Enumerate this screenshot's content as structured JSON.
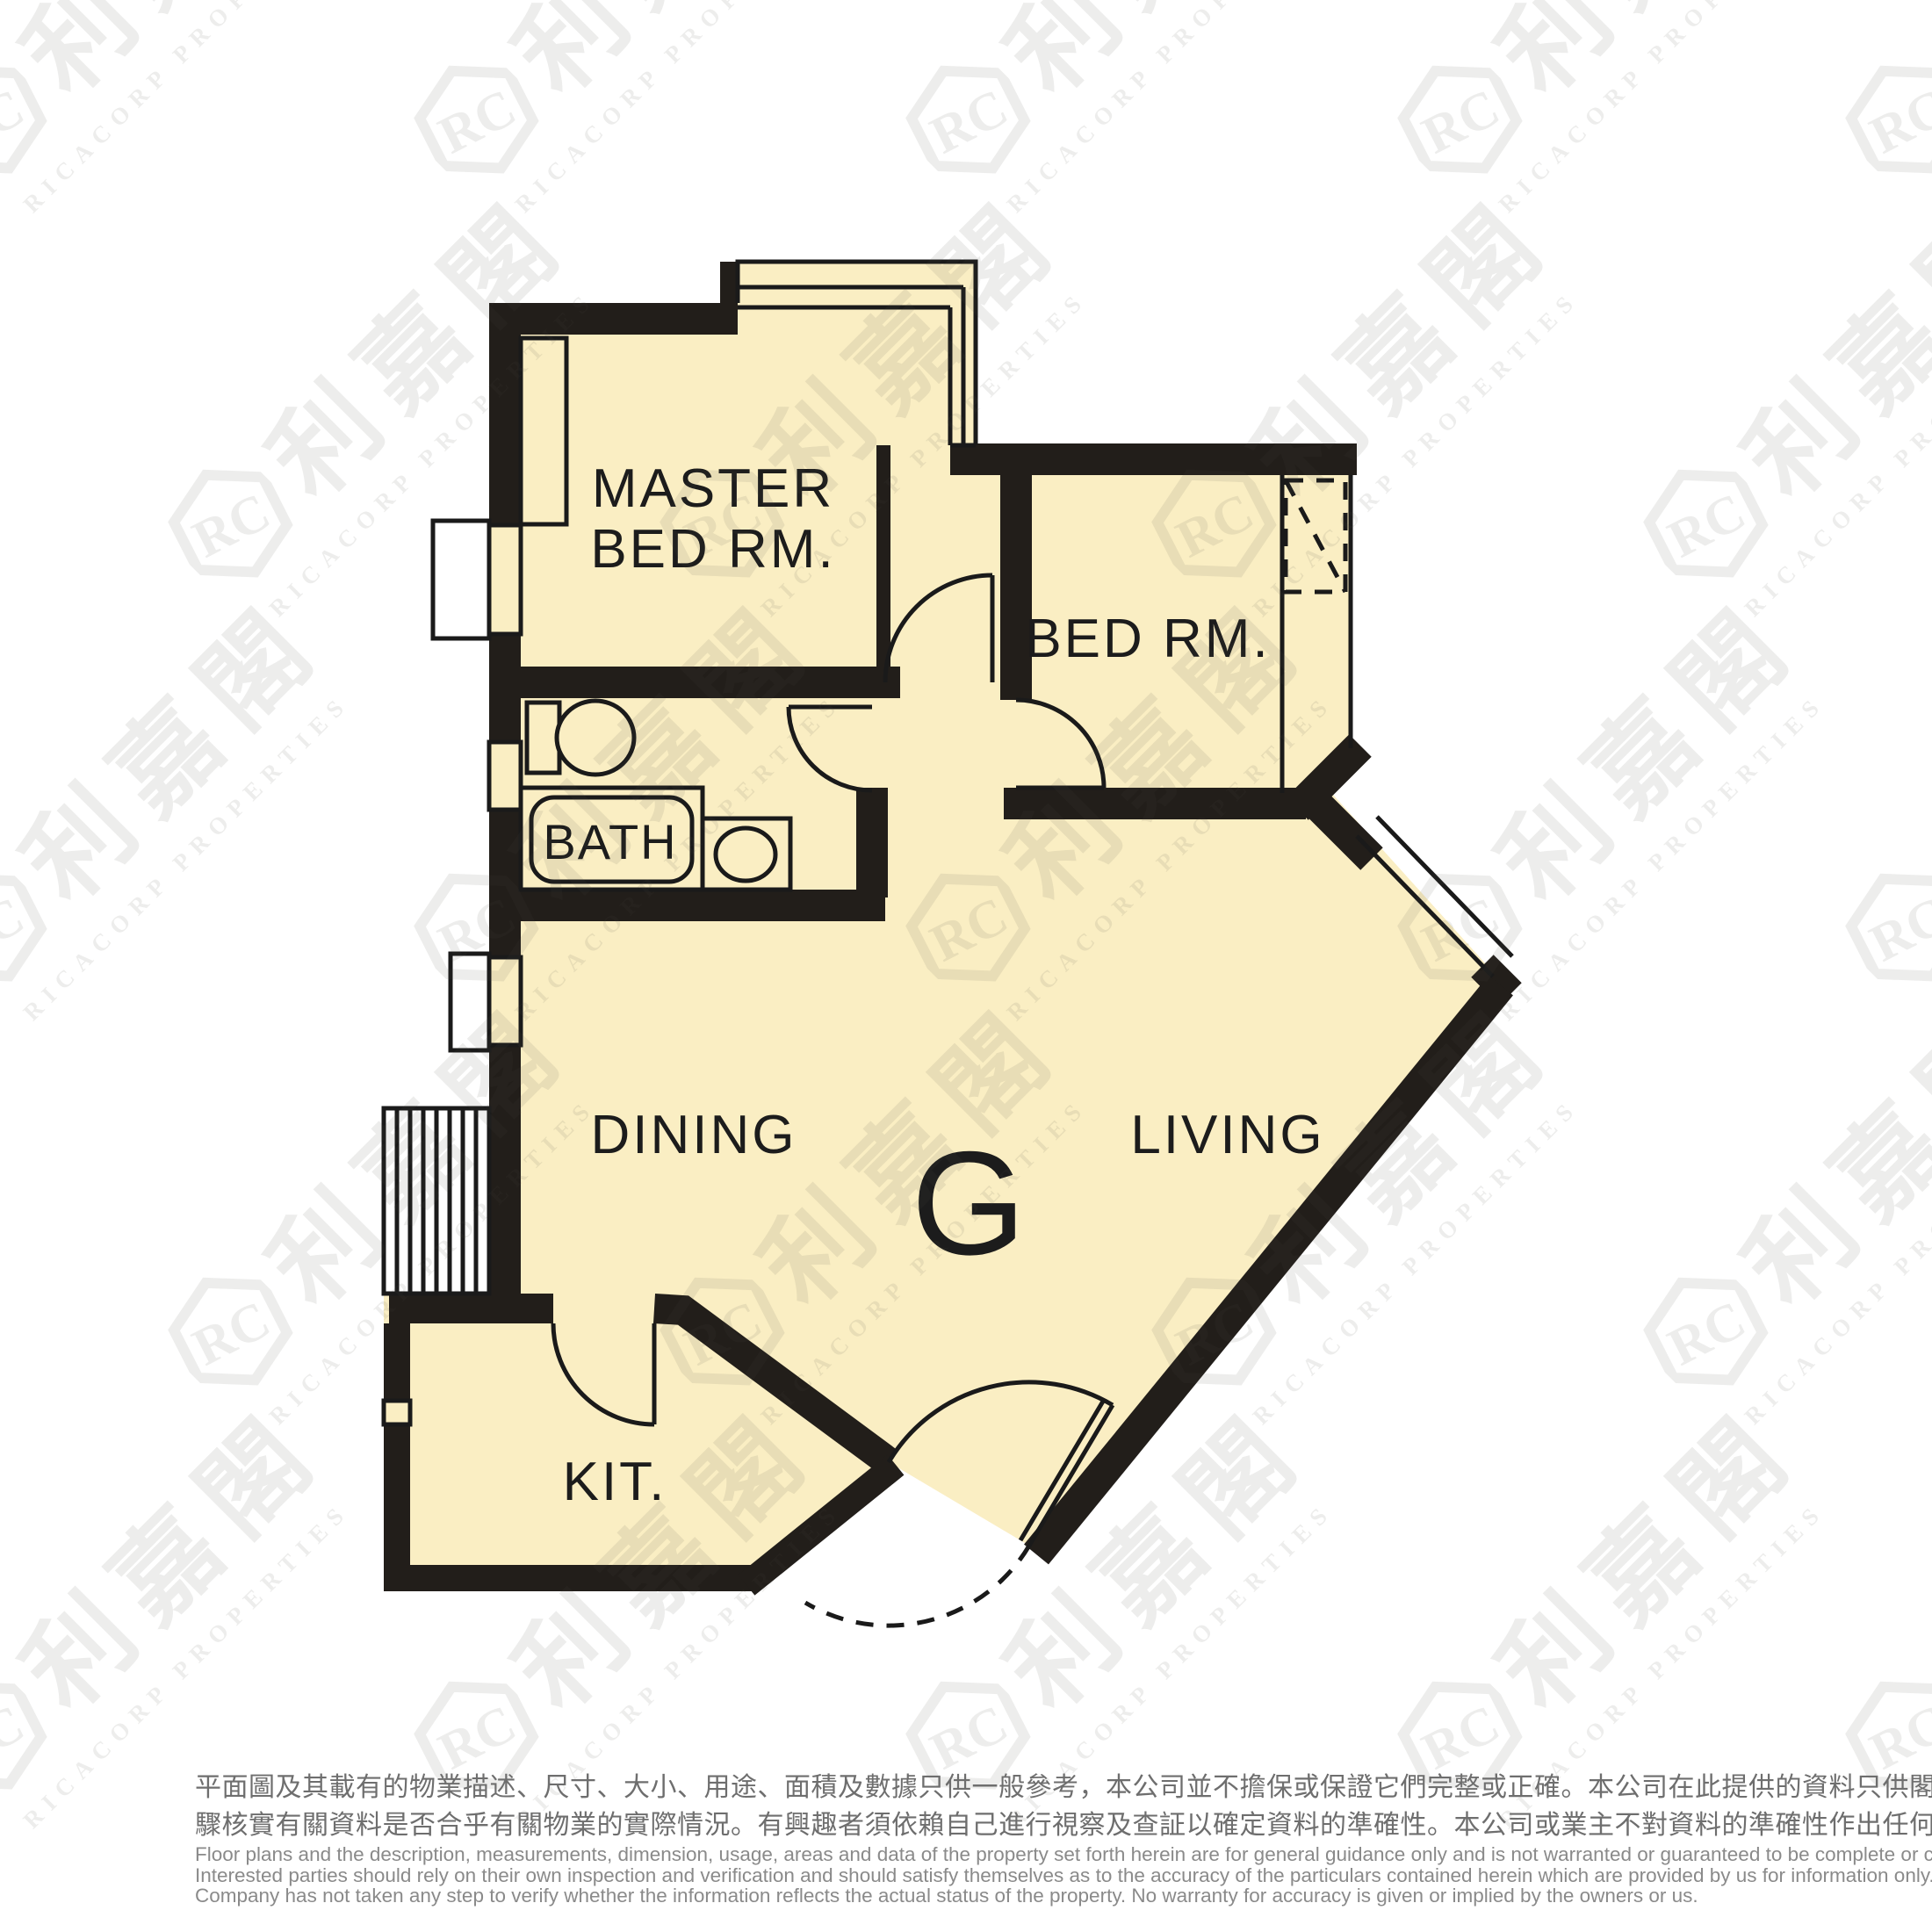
{
  "watermark": {
    "monogram": "RC",
    "brand_cjk": "利嘉閣",
    "brand_en": "RICACORP PROPERTIES"
  },
  "floor_plan": {
    "unit_label": "G",
    "rooms": {
      "master_bedroom": {
        "line1": "MASTER",
        "line2": "BED RM."
      },
      "bedroom": {
        "label": "BED RM."
      },
      "bathroom": {
        "label": "BATH"
      },
      "dining": {
        "label": "DINING"
      },
      "living": {
        "label": "LIVING"
      },
      "kitchen": {
        "label": "KIT."
      }
    },
    "colors": {
      "floor": "#FAEEC3",
      "wall": "#221E1A",
      "line": "#1A1A1A"
    }
  },
  "disclaimer": {
    "zh_lines": [
      "平面圖及其載有的物業描述、尺寸、大小、用途、面積及數據只供一般參考，本公司並不擔保或保證它們完整或正確。本公司在此提供的資料只供閣下參考，本公司並無採取任何步",
      "驟核實有關資料是否合乎有關物業的實際情況。有興趣者須依賴自己進行視察及查証以確定資料的準確性。本公司或業主不對資料的準確性作出任何明示或隱含的保證。"
    ],
    "en_lines": [
      "Floor plans and the description, measurements, dimension, usage, areas and data of the property set forth herein are for general guidance only and is not warranted or guaranteed to be complete or correct.",
      "Interested parties should rely on their own inspection and verification and should satisfy themselves as to the accuracy of the particulars contained herein which are provided by us for information only.  Our",
      "Company has not taken any step to verify whether the information reflects the actual status of the property.  No warranty for accuracy is given or implied by the owners or us."
    ]
  }
}
